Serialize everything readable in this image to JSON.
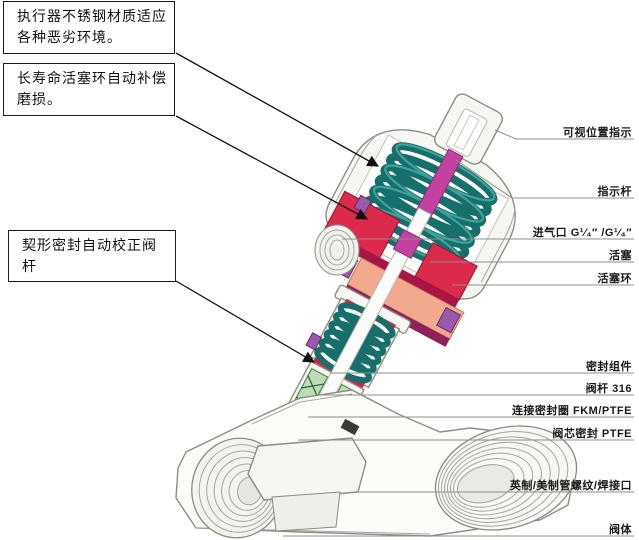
{
  "figure": {
    "description_domain": "angle-seat-valve-cutaway-diagram"
  },
  "callouts": [
    {
      "text": "执行器不锈钢材质适应各种恶劣环境。"
    },
    {
      "text": "长寿命活塞环自动补偿磨损。"
    },
    {
      "text": "契形密封自动校正阀杆"
    }
  ],
  "part_labels": [
    {
      "text": "可视位置指示"
    },
    {
      "text": "指示杆"
    },
    {
      "text": "进气口 G¹⁄₄″ /G¹⁄₄″"
    },
    {
      "text": "活塞"
    },
    {
      "text": "活塞环"
    },
    {
      "text": "密封组件"
    },
    {
      "text": "阀杆 316"
    },
    {
      "text": "连接密封圈 FKM/PTFE"
    },
    {
      "text": "阀芯密封 PTFE"
    },
    {
      "text": "英制/美制管螺纹/焊接口"
    },
    {
      "text": "阀体"
    }
  ],
  "palette": {
    "spring_teal": "#176f6b",
    "spring_teal_light": "#3fa29b",
    "stem_magenta": "#c2439f",
    "stem_magenta_dark": "#8e2b75",
    "piston_red": "#dc2a4c",
    "piston_red_dark": "#9a0f33",
    "piston_ring_salmon": "#f3a98e",
    "salmon_dark": "#bc7a5f",
    "seal_purple": "#9b59ac",
    "seal_purple_dark": "#5e2d70",
    "pack_green": "#bcdcb6",
    "pack_green_dark": "#47784a",
    "ring_red": "#cf2448",
    "metal_white": "#f6f6f2",
    "outline_gray": "#8d8d88",
    "text_black": "#1a1a1a"
  }
}
